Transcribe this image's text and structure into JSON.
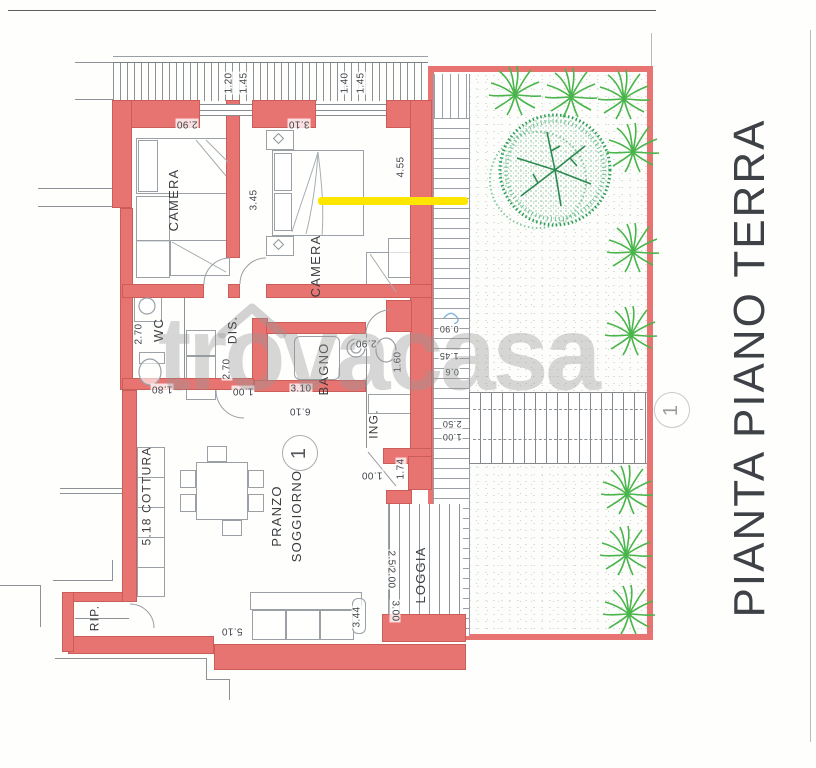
{
  "title": {
    "text": "PIANTA PIANO TERRA"
  },
  "watermark": {
    "text": "trovacasa"
  },
  "colors": {
    "wall": "#e87471",
    "yellow": "#ffe600",
    "bush": "#49b54b",
    "tree": "#2f9e5a",
    "line": "#8d9296",
    "text": "#3a3d40",
    "dim": "#3e4144",
    "title": "#3e4246",
    "watermark": "rgba(150,150,150,0.38)"
  },
  "room_labels": [
    {
      "name": "room-label-camera-1",
      "text": "CAMERA",
      "x": 174,
      "y": 200,
      "rot": -90,
      "size": 13
    },
    {
      "name": "room-label-camera-2",
      "text": "CAMERA",
      "x": 316,
      "y": 266,
      "rot": -90,
      "size": 13
    },
    {
      "name": "room-label-wc",
      "text": "WC",
      "x": 159,
      "y": 330,
      "rot": -90,
      "size": 13
    },
    {
      "name": "room-label-dis",
      "text": "DIS.",
      "x": 233,
      "y": 330,
      "rot": -90,
      "size": 12
    },
    {
      "name": "room-label-bagno",
      "text": "BAGNO",
      "x": 324,
      "y": 369,
      "rot": -90,
      "size": 13
    },
    {
      "name": "room-label-ing",
      "text": "ING.",
      "x": 374,
      "y": 424,
      "rot": -90,
      "size": 12
    },
    {
      "name": "room-label-pranzo-soggiorno",
      "text": "PRANZO\nSOGGIORNO",
      "x": 287,
      "y": 516,
      "rot": -90,
      "size": 13
    },
    {
      "name": "room-label-cottura",
      "text": "5.18 COTTURA",
      "x": 147,
      "y": 496,
      "rot": -90,
      "size": 12
    },
    {
      "name": "room-label-rip",
      "text": "RIP.",
      "x": 95,
      "y": 618,
      "rot": -90,
      "size": 12
    },
    {
      "name": "room-label-loggia",
      "text": "LOGGIA",
      "x": 421,
      "y": 575,
      "rot": -90,
      "size": 13
    }
  ],
  "dim_labels": [
    {
      "name": "dim-label",
      "text": "1.20",
      "x": 229,
      "y": 83,
      "rot": -90
    },
    {
      "name": "dim-label",
      "text": "1.45",
      "x": 244,
      "y": 83,
      "rot": -90
    },
    {
      "name": "dim-label",
      "text": "1.40",
      "x": 345,
      "y": 83,
      "rot": -90
    },
    {
      "name": "dim-label",
      "text": "1.45",
      "x": 361,
      "y": 83,
      "rot": -90
    },
    {
      "name": "dim-label",
      "text": "2.90",
      "x": 187,
      "y": 124,
      "rot": 180
    },
    {
      "name": "dim-label",
      "text": "3.10",
      "x": 299,
      "y": 124,
      "rot": 180
    },
    {
      "name": "dim-label",
      "text": "3.45",
      "x": 254,
      "y": 200,
      "rot": -90
    },
    {
      "name": "dim-label",
      "text": "4.55",
      "x": 401,
      "y": 167,
      "rot": -90
    },
    {
      "name": "dim-label",
      "text": "2.70",
      "x": 139,
      "y": 334,
      "rot": -90
    },
    {
      "name": "dim-label",
      "text": "1.80",
      "x": 162,
      "y": 389,
      "rot": 180
    },
    {
      "name": "dim-label",
      "text": "2.70",
      "x": 227,
      "y": 369,
      "rot": -90
    },
    {
      "name": "dim-label",
      "text": "1.00",
      "x": 243,
      "y": 391,
      "rot": 180
    },
    {
      "name": "dim-label",
      "text": "2.90",
      "x": 366,
      "y": 343,
      "rot": 180
    },
    {
      "name": "dim-label",
      "text": "1.60",
      "x": 398,
      "y": 362,
      "rot": -90
    },
    {
      "name": "dim-label",
      "text": "6.10",
      "x": 300,
      "y": 411,
      "rot": 180
    },
    {
      "name": "dim-label",
      "text": "3.10",
      "x": 301,
      "y": 389,
      "rot": 0
    },
    {
      "name": "dim-label",
      "text": "1.00",
      "x": 372,
      "y": 475,
      "rot": 180
    },
    {
      "name": "dim-label",
      "text": "1.74",
      "x": 401,
      "y": 469,
      "rot": -90
    },
    {
      "name": "dim-label",
      "text": "0.90",
      "x": 449,
      "y": 329,
      "rot": 180,
      "size": 9
    },
    {
      "name": "dim-label",
      "text": "1.45",
      "x": 449,
      "y": 356,
      "rot": 180,
      "size": 9
    },
    {
      "name": "dim-label",
      "text": "0.6",
      "x": 452,
      "y": 372,
      "rot": 180,
      "size": 9
    },
    {
      "name": "dim-label",
      "text": "2.50",
      "x": 452,
      "y": 424,
      "rot": 180,
      "size": 9
    },
    {
      "name": "dim-label",
      "text": "1.00",
      "x": 452,
      "y": 437,
      "rot": 180,
      "size": 9
    },
    {
      "name": "dim-label",
      "text": "2.50",
      "x": 391,
      "y": 561,
      "rot": 90
    },
    {
      "name": "dim-label",
      "text": "2.00",
      "x": 391,
      "y": 578,
      "rot": 90
    },
    {
      "name": "dim-label",
      "text": "3.00",
      "x": 395,
      "y": 611,
      "rot": 90
    },
    {
      "name": "dim-label",
      "text": "5.10",
      "x": 232,
      "y": 631,
      "rot": 180
    },
    {
      "name": "dim-label",
      "text": "3.44",
      "x": 357,
      "y": 617,
      "rot": -90
    }
  ],
  "markers": [
    {
      "text": "1",
      "x": 300,
      "y": 453,
      "variant": "dark"
    },
    {
      "text": "1",
      "x": 672,
      "y": 410,
      "variant": "light"
    }
  ]
}
